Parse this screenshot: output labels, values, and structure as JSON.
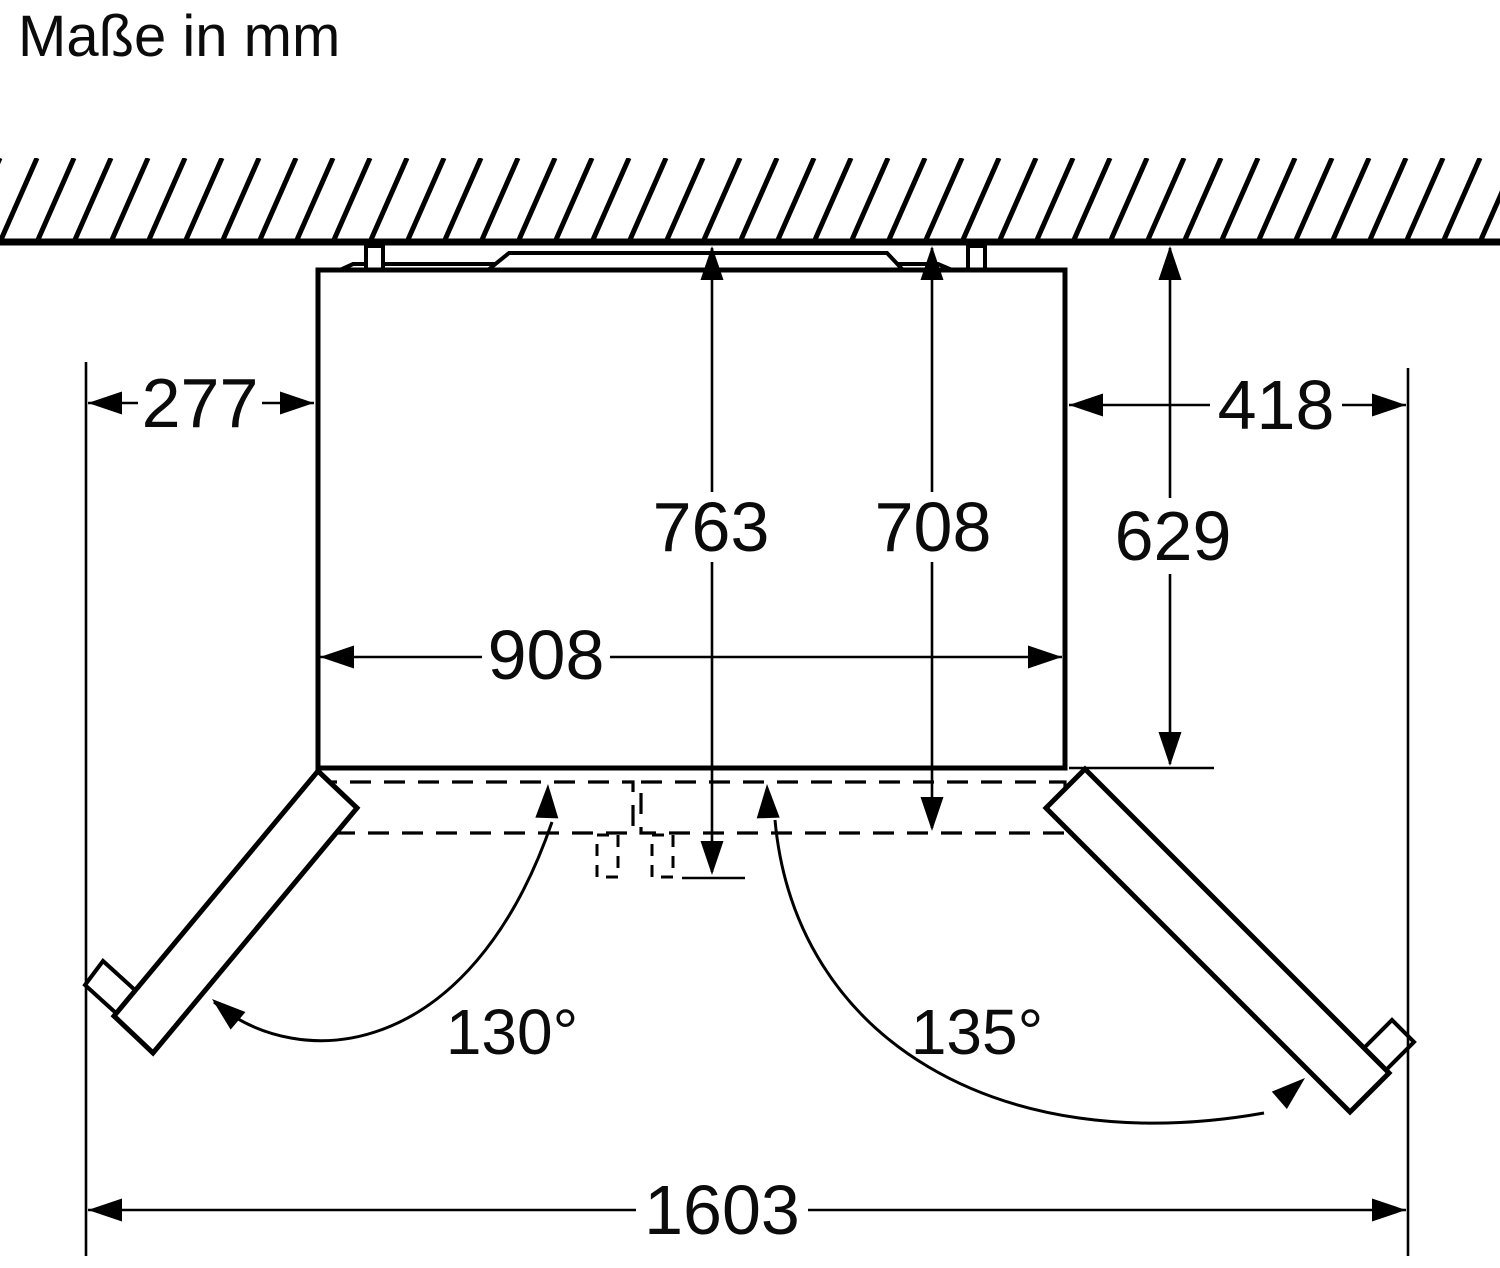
{
  "diagram": {
    "title": "Maße in mm",
    "unit": "mm",
    "colors": {
      "line": "#000000",
      "background": "#ffffff"
    },
    "dimensions": {
      "clearance_left": "277",
      "clearance_right": "418",
      "depth_body": "629",
      "depth_total": "763",
      "depth_door": "708",
      "width_body": "908",
      "width_total": "1603",
      "door_angle_left": "130°",
      "door_angle_right": "135°"
    }
  }
}
